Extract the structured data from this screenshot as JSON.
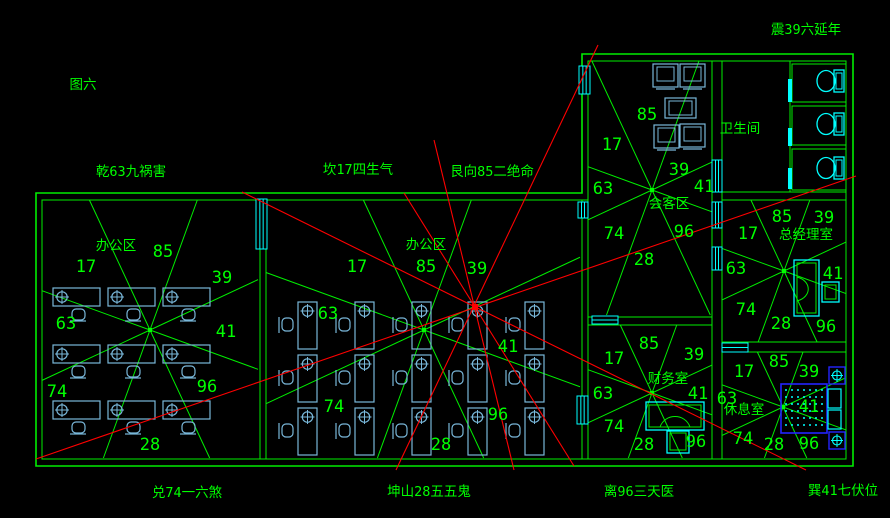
{
  "figure_label": "图六",
  "colors": {
    "background": "#000000",
    "wall_green": "#00ee00",
    "text_green": "#00ff00",
    "furniture_blue": "#79b7d9",
    "fixture_cyan": "#00ffff",
    "bed_blue": "#2424ff",
    "analysis_red": "#ff0000"
  },
  "perimeter_labels": [
    {
      "id": "figure-number",
      "text": "图六",
      "x": 83,
      "y": 89
    },
    {
      "id": "dir-qian",
      "text": "乾63九祸害",
      "x": 131,
      "y": 176
    },
    {
      "id": "dir-kan",
      "text": "坎17四生气",
      "x": 358,
      "y": 174
    },
    {
      "id": "dir-gen",
      "text": "艮向85二绝命",
      "x": 492,
      "y": 176
    },
    {
      "id": "dir-zhen",
      "text": "震39六延年",
      "x": 806,
      "y": 34
    },
    {
      "id": "dir-dui",
      "text": "兑74一六煞",
      "x": 187,
      "y": 497
    },
    {
      "id": "dir-kun",
      "text": "坤山28五五鬼",
      "x": 429,
      "y": 496
    },
    {
      "id": "dir-li",
      "text": "离96三天医",
      "x": 639,
      "y": 496
    },
    {
      "id": "dir-xun",
      "text": "巽41七伏位",
      "x": 843,
      "y": 495
    }
  ],
  "rooms": [
    {
      "id": "office-left",
      "label": "办公区",
      "label_x": 116,
      "label_y": 250,
      "center": [
        150,
        330
      ],
      "rect": [
        42,
        200,
        258,
        458
      ],
      "numbers": [
        {
          "v": "17",
          "x": 86,
          "y": 272
        },
        {
          "v": "85",
          "x": 163,
          "y": 257
        },
        {
          "v": "39",
          "x": 222,
          "y": 283
        },
        {
          "v": "63",
          "x": 66,
          "y": 329
        },
        {
          "v": "41",
          "x": 226,
          "y": 337
        },
        {
          "v": "74",
          "x": 57,
          "y": 397
        },
        {
          "v": "96",
          "x": 207,
          "y": 392
        },
        {
          "v": "28",
          "x": 150,
          "y": 450
        }
      ]
    },
    {
      "id": "office-middle",
      "label": "办公区",
      "label_x": 426,
      "label_y": 249,
      "center": [
        424,
        330
      ],
      "rect": [
        266,
        200,
        580,
        458
      ],
      "numbers": [
        {
          "v": "17",
          "x": 357,
          "y": 272
        },
        {
          "v": "85",
          "x": 426,
          "y": 272
        },
        {
          "v": "39",
          "x": 477,
          "y": 274
        },
        {
          "v": "63",
          "x": 328,
          "y": 319
        },
        {
          "v": "41",
          "x": 508,
          "y": 352
        },
        {
          "v": "74",
          "x": 334,
          "y": 412
        },
        {
          "v": "96",
          "x": 498,
          "y": 420
        },
        {
          "v": "28",
          "x": 441,
          "y": 450
        }
      ]
    },
    {
      "id": "meeting-room",
      "label": "会客区",
      "label_x": 669,
      "label_y": 208,
      "center": [
        652,
        190
      ],
      "rect": [
        588,
        61,
        712,
        315
      ],
      "numbers": [
        {
          "v": "85",
          "x": 647,
          "y": 120
        },
        {
          "v": "17",
          "x": 612,
          "y": 150
        },
        {
          "v": "39",
          "x": 679,
          "y": 175
        },
        {
          "v": "63",
          "x": 603,
          "y": 194
        },
        {
          "v": "41",
          "x": 704,
          "y": 192
        },
        {
          "v": "74",
          "x": 614,
          "y": 239
        },
        {
          "v": "96",
          "x": 684,
          "y": 237
        },
        {
          "v": "28",
          "x": 644,
          "y": 265
        }
      ]
    },
    {
      "id": "bathroom",
      "label": "卫生间",
      "label_x": 740,
      "label_y": 133,
      "center": null,
      "rect": [
        722,
        61,
        846,
        192
      ],
      "numbers": []
    },
    {
      "id": "manager-room",
      "label": "总经理室",
      "label_x": 806,
      "label_y": 239,
      "center": [
        784,
        271
      ],
      "rect": [
        722,
        200,
        846,
        342
      ],
      "numbers": [
        {
          "v": "85",
          "x": 782,
          "y": 222
        },
        {
          "v": "39",
          "x": 824,
          "y": 223
        },
        {
          "v": "17",
          "x": 748,
          "y": 239
        },
        {
          "v": "63",
          "x": 736,
          "y": 274
        },
        {
          "v": "41",
          "x": 833,
          "y": 279
        },
        {
          "v": "74",
          "x": 746,
          "y": 315
        },
        {
          "v": "28",
          "x": 781,
          "y": 329
        },
        {
          "v": "96",
          "x": 826,
          "y": 332
        }
      ]
    },
    {
      "id": "finance-room",
      "label": "财务室",
      "label_x": 668,
      "label_y": 383,
      "center": [
        652,
        393
      ],
      "rect": [
        588,
        325,
        712,
        458
      ],
      "numbers": [
        {
          "v": "85",
          "x": 649,
          "y": 349
        },
        {
          "v": "17",
          "x": 614,
          "y": 364
        },
        {
          "v": "39",
          "x": 694,
          "y": 360
        },
        {
          "v": "63",
          "x": 603,
          "y": 399
        },
        {
          "v": "41",
          "x": 698,
          "y": 399
        },
        {
          "v": "74",
          "x": 614,
          "y": 432
        },
        {
          "v": "28",
          "x": 644,
          "y": 450
        },
        {
          "v": "96",
          "x": 696,
          "y": 447
        }
      ]
    },
    {
      "id": "rest-room",
      "label": "休息室",
      "label_x": 744,
      "label_y": 414,
      "center": [
        783,
        407
      ],
      "rect": [
        722,
        352,
        846,
        458
      ],
      "numbers": [
        {
          "v": "85",
          "x": 779,
          "y": 367
        },
        {
          "v": "17",
          "x": 744,
          "y": 377
        },
        {
          "v": "39",
          "x": 809,
          "y": 377
        },
        {
          "v": "63",
          "x": 727,
          "y": 404
        },
        {
          "v": "41",
          "x": 809,
          "y": 412
        },
        {
          "v": "74",
          "x": 743,
          "y": 444
        },
        {
          "v": "28",
          "x": 774,
          "y": 450
        },
        {
          "v": "96",
          "x": 809,
          "y": 449
        }
      ]
    }
  ],
  "star_spoke_angles_deg": [
    20,
    65,
    110,
    155,
    200,
    245,
    290,
    335
  ],
  "walls": {
    "outer": [
      [
        36,
        193
      ],
      [
        582,
        193
      ],
      [
        582,
        54
      ],
      [
        853,
        54
      ],
      [
        853,
        466
      ],
      [
        36,
        466
      ]
    ],
    "inner": [
      [
        42,
        200
      ],
      [
        588,
        200
      ],
      [
        588,
        61
      ],
      [
        846,
        61
      ],
      [
        846,
        459
      ],
      [
        42,
        459
      ]
    ],
    "segments": [
      [
        260,
        200,
        260,
        459
      ],
      [
        266,
        200,
        266,
        459
      ],
      [
        582,
        200,
        582,
        459
      ],
      [
        588,
        200,
        588,
        459
      ],
      [
        712,
        61,
        712,
        459
      ],
      [
        722,
        61,
        722,
        459
      ],
      [
        722,
        192,
        846,
        192
      ],
      [
        722,
        200,
        846,
        200
      ],
      [
        588,
        317,
        712,
        317
      ],
      [
        588,
        325,
        712,
        325
      ],
      [
        722,
        342,
        846,
        342
      ],
      [
        722,
        352,
        846,
        352
      ],
      [
        790,
        61,
        790,
        192
      ]
    ],
    "bath_stalls": [
      [
        792,
        64,
        846,
        102
      ],
      [
        792,
        106,
        846,
        145
      ],
      [
        792,
        149,
        846,
        190
      ]
    ]
  },
  "windows": [
    {
      "x": 579,
      "y": 66,
      "w": 11,
      "h": 28,
      "dir": "v"
    },
    {
      "x": 256,
      "y": 199,
      "w": 11,
      "h": 50,
      "dir": "v"
    },
    {
      "x": 578,
      "y": 202,
      "w": 10,
      "h": 16,
      "dir": "v"
    },
    {
      "x": 577,
      "y": 396,
      "w": 11,
      "h": 28,
      "dir": "v"
    },
    {
      "x": 712,
      "y": 160,
      "w": 10,
      "h": 32,
      "dir": "v"
    },
    {
      "x": 712,
      "y": 202,
      "w": 10,
      "h": 26,
      "dir": "v"
    },
    {
      "x": 712,
      "y": 247,
      "w": 10,
      "h": 23,
      "dir": "v"
    },
    {
      "x": 722,
      "y": 343,
      "w": 26,
      "h": 9,
      "dir": "h"
    },
    {
      "x": 592,
      "y": 316,
      "w": 26,
      "h": 8,
      "dir": "h"
    }
  ],
  "door_gaps": [
    {
      "x": 790,
      "y1": 79,
      "y2": 102
    },
    {
      "x": 790,
      "y1": 128,
      "y2": 146
    },
    {
      "x": 790,
      "y1": 168,
      "y2": 189
    }
  ],
  "red_lines": [
    [
      36,
      459,
      856,
      176
    ],
    [
      242,
      192,
      806,
      470
    ],
    [
      598,
      45,
      396,
      470
    ],
    [
      434,
      140,
      514,
      470
    ],
    [
      404,
      193,
      574,
      466
    ]
  ],
  "red_star": [
    475,
    307
  ],
  "desk_grid_horizontal": {
    "cols": [
      53,
      108,
      163
    ],
    "rows": [
      288,
      345,
      401
    ],
    "w": 47,
    "h": 18
  },
  "desk_grid_vertical": {
    "cols": [
      298,
      355,
      412,
      468,
      525
    ],
    "rows": [
      302,
      355,
      408
    ],
    "w": 19,
    "h": 47
  },
  "meeting_furniture": {
    "armchairs": [
      [
        653,
        64
      ],
      [
        680,
        64
      ],
      [
        654,
        125
      ],
      [
        680,
        124
      ]
    ],
    "armchair_w": 25,
    "armchair_h": 23,
    "table": [
      665,
      98,
      31,
      20
    ]
  },
  "toilets": [
    {
      "bx": 826,
      "by": 81,
      "tx": 834,
      "ty": 70
    },
    {
      "bx": 826,
      "by": 124,
      "tx": 834,
      "ty": 113
    },
    {
      "bx": 826,
      "by": 168,
      "tx": 834,
      "ty": 157
    }
  ],
  "manager_desk": {
    "rect": [
      794,
      260,
      25,
      56
    ],
    "inner": [
      797,
      263,
      19,
      50
    ],
    "chair": [
      822,
      282,
      17,
      20
    ]
  },
  "finance_desk": {
    "rect": [
      646,
      402,
      58,
      28
    ],
    "inner": [
      649,
      405,
      52,
      22
    ],
    "chair": [
      667,
      431,
      22,
      22
    ]
  },
  "rest_bed": {
    "bed": [
      781,
      384,
      46,
      49
    ],
    "panels": [
      [
        828,
        389,
        13,
        19
      ],
      [
        828,
        410,
        13,
        19
      ]
    ],
    "nightstands": [
      [
        829,
        367,
        16,
        17
      ],
      [
        829,
        432,
        16,
        17
      ]
    ]
  }
}
